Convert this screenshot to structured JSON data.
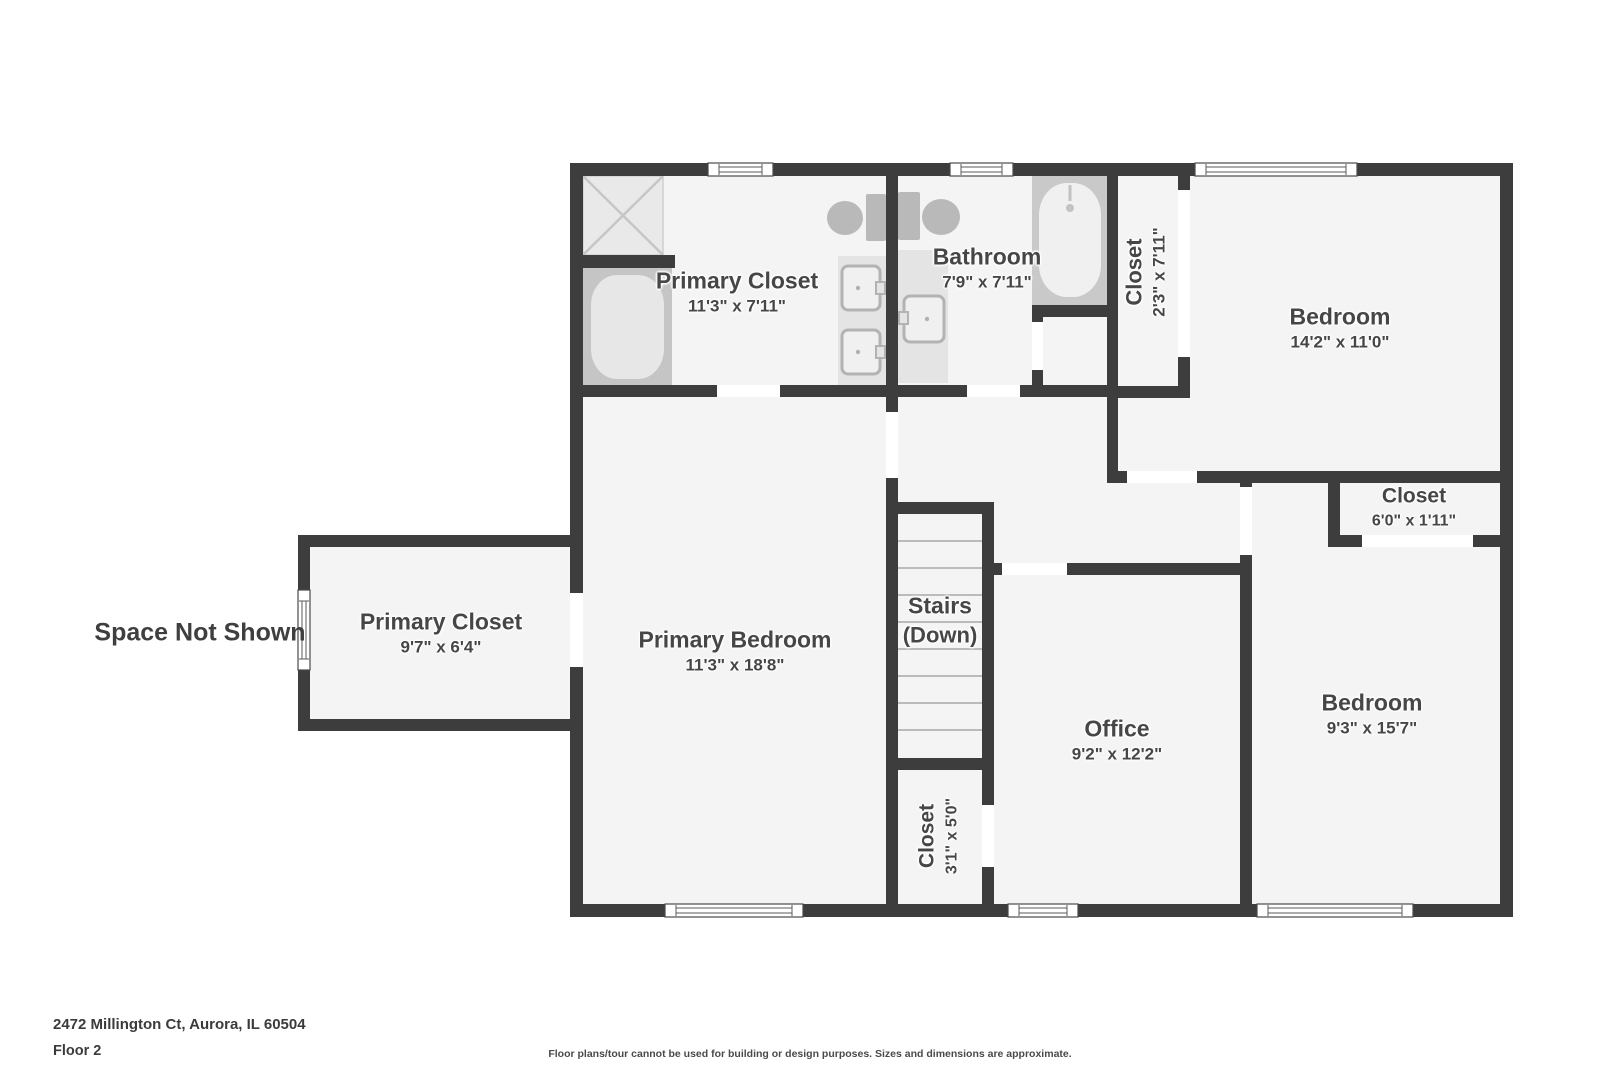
{
  "floor_plan": {
    "rooms": [
      {
        "id": "primary_closet_upper",
        "name": "Primary Closet",
        "dims": "11'3\" x 7'11\""
      },
      {
        "id": "bathroom",
        "name": "Bathroom",
        "dims": "7'9\" x 7'11\""
      },
      {
        "id": "closet_hall_upper",
        "name": "Closet",
        "dims": "2'3\" x 7'11\""
      },
      {
        "id": "bedroom_upper_right",
        "name": "Bedroom",
        "dims": "14'2\" x 11'0\""
      },
      {
        "id": "primary_closet_left",
        "name": "Primary Closet",
        "dims": "9'7\" x 6'4\""
      },
      {
        "id": "primary_bedroom",
        "name": "Primary Bedroom",
        "dims": "11'3\" x 18'8\""
      },
      {
        "id": "stairs",
        "name": "Stairs",
        "dims": "(Down)"
      },
      {
        "id": "office",
        "name": "Office",
        "dims": "9'2\" x 12'2\""
      },
      {
        "id": "closet_bedroom_right",
        "name": "Closet",
        "dims": "6'0\" x 1'11\""
      },
      {
        "id": "bedroom_lower_right",
        "name": "Bedroom",
        "dims": "9'3\" x 15'7\""
      },
      {
        "id": "closet_by_stairs",
        "name": "Closet",
        "dims": "3'1\" x 5'0\""
      }
    ],
    "annotations": {
      "space_not_shown": "Space Not Shown"
    },
    "footer": {
      "address": "2472 Millington Ct, Aurora, IL 60504",
      "floor": "Floor 2",
      "disclaimer": "Floor plans/tour cannot be used for building or design purposes. Sizes and dimensions are approximate."
    },
    "colors": {
      "wall": "#3d3d3d",
      "floor": "#f4f4f4",
      "fixture_dark": "#c7c7c7",
      "fixture_light": "#e9e9e9",
      "label_text": "#464646"
    }
  }
}
